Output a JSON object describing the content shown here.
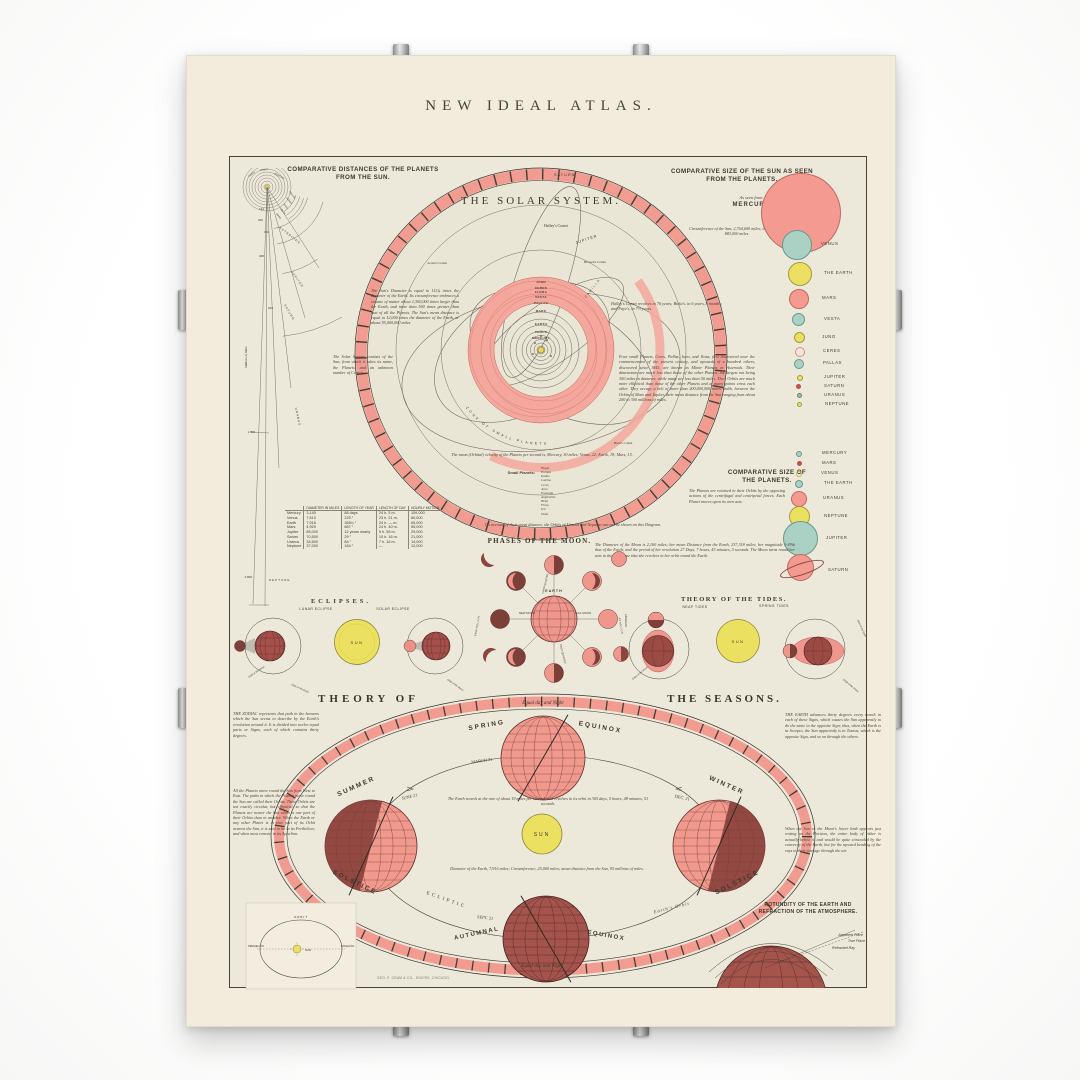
{
  "title": "NEW IDEAL ATLAS.",
  "palette": {
    "paper": "#f2ecdd",
    "chart_bg": "#ece9da",
    "ink": "#433b2f",
    "pink": "#f2998e",
    "pink_band": "#f4a79c",
    "maroon": "#9c4b44",
    "dark_maroon": "#7c4038",
    "teal": "#abd0c4",
    "yellow": "#ece061",
    "sun_yellow": "#e8d95a"
  },
  "distances": {
    "title_l1": "COMPARATIVE DISTANCES OF THE PLANETS",
    "title_l2": "FROM THE SUN.",
    "scale": "Millions of Miles",
    "ticks": [
      "142",
      "200",
      "310",
      "495",
      "910",
      "1,800",
      "2,800"
    ],
    "labels": {
      "earth": "EARTH",
      "venus": "VENUS",
      "mercury": "MERCURY",
      "pallas": "PALLAS",
      "ceres": "CERES",
      "juno": "JUNO",
      "vesta": "VESTA",
      "mars": "MARS",
      "asteroids": "ASTEROIDS",
      "jupiter": "JUPITER",
      "saturn": "SATURN",
      "uranus": "URANUS",
      "neptune": "NEPTUNE"
    }
  },
  "solar": {
    "title": "THE SOLAR SYSTEM.",
    "saturn": "SATURN",
    "jupiter": "JUPITER",
    "halleys": "Halley's Comet",
    "brorsens": "Brorsen's Comet",
    "arrests": "Arrest's Comet",
    "bielas": "Biela's Comet",
    "camilla": "CAMILLA",
    "zone": "ZONE OF SMALL PLANETS",
    "ring": [
      "JUNO",
      "CERES",
      "FLORA",
      "VESTA",
      "PALLAS",
      "MARS",
      "EARTH",
      "VENUS",
      "MERCURY"
    ],
    "sun_note": "The Sun's Diameter is equal to 111¾ times the diameter of the Earth. Its circumference embraces a volume of matter about 1,300,000 times larger than the Earth, and more than 500 times greater than that of all the Planets. The Sun's mean distance is equal to 12,000 times the diameter of the Earth, or about 95,000,000 miles.",
    "system_note": "The Solar System consists of the Sun, from which it takes its name, the Planets, and an unknown number of Comets.",
    "comet_note": "Halley's Comet revolves in 76 years; Biela's, in 6 years, 8 months; and Faye's, in 7½ years.",
    "asteroid_note": "Four small Planets, Ceres, Pallas, Juno, and Vesta, first discovered near the commencement of the present century, and upwards of a hundred others, discovered since 1845, are known as Minor Planets or Asteroids. Their dimensions are much less than those of the other Planets, the largest not being 300 miles in diameter, while many are less than 50 miles. Their Orbits are much more elliptical than those of the other Planets and at many points cross each other. They occupy a belt of more than 200,000,000 miles width, between the Orbits of Mars and Jupiter, their mean distance from the Sun ranging from about 200 to 300 millions of miles.",
    "velocity_note": "The mean (Orbital) velocity of the Planets per second is, Mercury, 30 miles; Venus, 22; Earth, 19; Mars, 15.",
    "small_planets_label": "Small Planets:",
    "small_planets": [
      "Hygia",
      "Europa",
      "Pallas",
      "Lutetia",
      "Ceres",
      "Juno",
      "Eunomia",
      "Amphitrite",
      "Hebe",
      "Flora",
      "Iris",
      "Vesta"
    ],
    "distance_note": "On account of their great distance, the Orbits of Uranus and Neptune can not be shown on this Diagram."
  },
  "sun_sizes": {
    "title_l1": "COMPARATIVE SIZE OF THE SUN AS SEEN",
    "title_l2": "FROM THE PLANETS.",
    "as_seen_from": "As seen from",
    "mercury": "MERCURY",
    "circumference_note": "Circumference of the Sun, 2,764,600 miles; the Diameter, 883,000 miles.",
    "items": [
      {
        "label": "VENUS"
      },
      {
        "label": "THE EARTH"
      },
      {
        "label": "MARS"
      },
      {
        "label": "VESTA"
      },
      {
        "label": "JUNO"
      },
      {
        "label": "CERES"
      },
      {
        "label": "PALLAS"
      },
      {
        "label": "JUPITER"
      },
      {
        "label": "SATURN"
      },
      {
        "label": "URANUS"
      },
      {
        "label": "NEPTUNE"
      }
    ]
  },
  "planet_sizes": {
    "title_l1": "COMPARATIVE SIZE OF",
    "title_l2": "THE PLANETS.",
    "orbit_note": "The Planets are retained in their Orbits by the opposing actions of the centrifugal and centripetal forces. Each Planet moves upon its own axis.",
    "items": [
      {
        "label": "MERCURY"
      },
      {
        "label": "MARS"
      },
      {
        "label": "VENUS"
      },
      {
        "label": "THE EARTH"
      },
      {
        "label": "URANUS"
      },
      {
        "label": "NEPTUNE"
      },
      {
        "label": "JUPITER"
      },
      {
        "label": "SATURN"
      }
    ]
  },
  "table": {
    "headers": [
      "",
      "DIAMETER IN MILES",
      "LENGTH OF YEAR",
      "LENGTH OF DAY",
      "HOURLY MOTION"
    ],
    "rows": [
      [
        "Mercury",
        "3,140",
        "88 days",
        "24 h. 5 m.",
        "109,000"
      ],
      [
        "Venus",
        "7,510",
        "225 ″",
        "23 h. 21 m.",
        "80,000"
      ],
      [
        "Earth",
        "7,916",
        "365¼ ″",
        "24 h. — m.",
        "65,000"
      ],
      [
        "Mars",
        "4,920",
        "687 ″",
        "24 h. 40 m.",
        "55,000"
      ],
      [
        "Jupiter",
        "85,000",
        "12 years nearly",
        "9 h. 55 m.",
        "29,000"
      ],
      [
        "Saturn",
        "70,500",
        "29 ″",
        "10 h. 16 m.",
        "21,000"
      ],
      [
        "Uranus",
        "34,500",
        "84 ″",
        "7 h. 16 m.",
        "14,000"
      ],
      [
        "Neptune",
        "37,000",
        "164 ″",
        "—",
        "12,000"
      ]
    ]
  },
  "moon": {
    "title": "PHASES OF THE MOON.",
    "earth": "EARTH",
    "new_moon": "NEW MOON",
    "full_moon": "FULL MOON",
    "first_quarter": "FIRST QUARTER",
    "third_quarter": "THIRD QUARTER",
    "perihelion": "PERIHELION",
    "aphelion": "APHELION",
    "note": "The Diameter of the Moon is 2,160 miles; her mean Distance from the Earth, 237,318 miles; her magnitude 1-49th that of the Earth; and the period of her revolution 27 Days, 7 hours, 43 minutes, 5 seconds. The Moon turns round her axis in the same time that she revolves in her orbit round the Earth."
  },
  "eclipses": {
    "title": "ECLIPSES.",
    "lunar": "LUNAR ECLIPSE",
    "solar": "SOLAR ECLIPSE",
    "sun": "SUN",
    "orbit_moon": "Orbit of the Moon",
    "orbit_earth": "Orbit of the Earth"
  },
  "tides": {
    "title": "THEORY OF THE TIDES.",
    "neap": "NEAP TIDES",
    "spring": "SPRING TIDES",
    "sun": "SUN",
    "orbit_moon": "Orbit of the Moon",
    "orbit_earth": "Orbit of the Earth",
    "aphelion": "APHELION"
  },
  "seasons": {
    "title_left": "THEORY OF",
    "title_right": "THE SEASONS.",
    "equal_top": "Equal day and Night",
    "equal_bottom": "Equal day and Night",
    "spring": "SPRING",
    "equinox": "EQUINOX",
    "march": "MARCH 21",
    "summer": "SUMMER",
    "june": "JUNE 21",
    "solstice_l": "SOLSTICE",
    "winter": "WINTER",
    "dec": "DEC. 21",
    "solstice_r": "SOLSTICE",
    "autumnal": "AUTUMNAL",
    "equinox_a": "EQUINOX",
    "sept": "SEPT. 21",
    "ecliptic": "ECLIPTIC",
    "earths_orbit": "Earth's Orbit",
    "sun": "SUN",
    "travel_note": "The Earth travels at the rate of about 19 miles per second, and revolves in its orbit in 365 days, 5 hours, 48 minutes, 51 seconds.",
    "diameter_note": "Diameter of the Earth, 7,916 miles; Circumference, 25,000 miles; mean distance from the Sun, 95 millions of miles.",
    "zodiac_note": "THE ZODIAC represents that path in the heavens which the Sun seems to describe by the Earth's revolution around it. It is divided into twelve equal parts or Signs, each of which contains thirty degrees.",
    "earth_note": "THE EARTH advances thirty degrees every month in each of these Signs, which causes the Sun apparently to do the same in the opposite Sign; thus, when the Earth is in Scorpio, the Sun apparently is in Taurus, which is the opposite Sign, and so on through the others.",
    "planets_note": "All the Planets move round the Sun from West to East. The paths in which the Planets move round the Sun are called their Orbits. These Orbits are not exactly circular, but elliptical, so that the Planets are nearer the Sun when in one part of their Orbits than in another. When the Earth or any other Planet is in that part of its Orbit nearest the Sun, it is said to be in its Perihelion; and when most remote, in its Aphelion.",
    "refraction_note": "When the Sun or the Moon's lower limb appears just resting on the Horizon, the entire body of either is actually below it, and would be quite concealed by the convexity of the Earth, but for the upward bending of the rays in their passage through the air."
  },
  "orbit_box": {
    "orbit": "ORBIT",
    "perihelion": "PERIHELION",
    "aphelion": "APHELION",
    "sun": "SUN"
  },
  "rotundity": {
    "title_l1": "ROTUNDITY OF THE EARTH AND",
    "title_l2": "REFRACTION OF THE ATMOSPHERE.",
    "apparent": "Apparent Place",
    "true_place": "True Place",
    "refracted": "Refracted Ray"
  },
  "publisher": "GEO. F. CRAM & CO., ENG'RS, CHICAGO."
}
